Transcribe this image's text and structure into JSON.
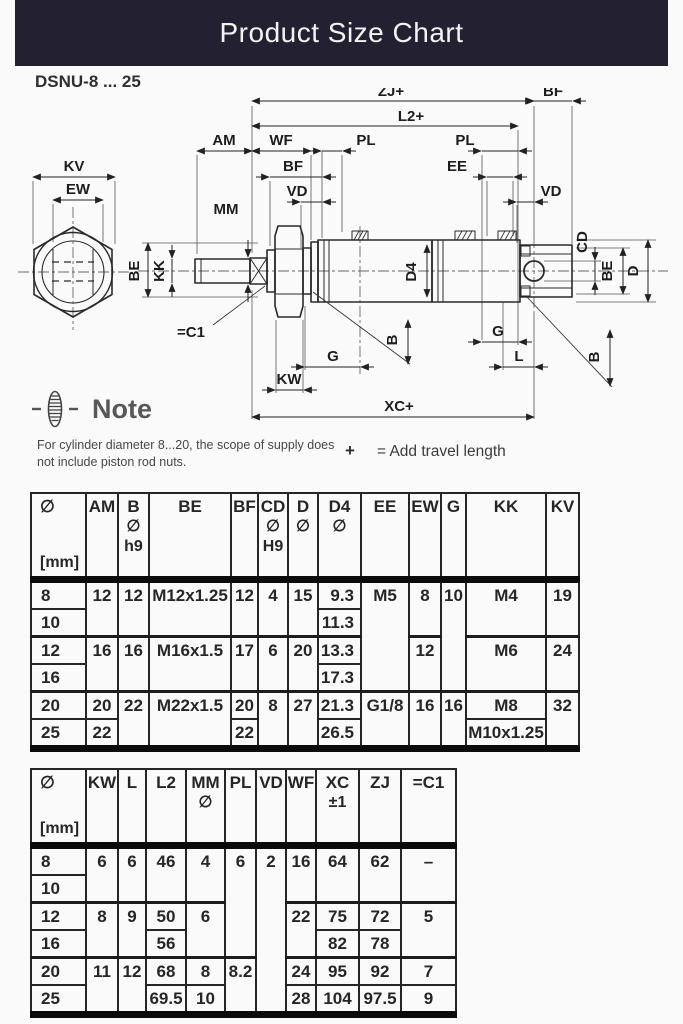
{
  "title": "Product Size Chart",
  "theme": {
    "header_bg": "#232032",
    "header_text": "#f3f3f3",
    "line": "#262626",
    "thick_line": "#0b0b0b"
  },
  "diagram": {
    "model": "DSNU-8 ... 25",
    "labels": {
      "zj": "ZJ+",
      "bf_top": "BF",
      "l2": "L2+",
      "am": "AM",
      "wf": "WF",
      "pl_left": "PL",
      "pl_right": "PL",
      "ee": "EE",
      "kv": "KV",
      "ew": "EW",
      "bf_left": "BF",
      "vd_left": "VD",
      "vd_right": "VD",
      "mm": "MM",
      "be_left": "BE",
      "kk": "KK",
      "d4": "D4",
      "cd": "CD",
      "be_right": "BE",
      "d": "D",
      "b_left": "B",
      "b_right": "B",
      "g_left": "G",
      "g_right": "G",
      "l": "L",
      "kw": "KW",
      "xc": "XC+",
      "torque": "=C1"
    }
  },
  "note": {
    "heading": "Note",
    "body": "For cylinder diameter 8...20, the scope of supply does not include piston rod nuts.",
    "plus": "+",
    "travel": "= Add travel length"
  },
  "table1": {
    "headers": {
      "dia": {
        "l1": "∅",
        "l3": "[mm]"
      },
      "am": "AM",
      "b": {
        "l1": "B",
        "l2": "∅",
        "l3": "h9"
      },
      "be": "BE",
      "bf": "BF",
      "cd": {
        "l1": "CD",
        "l2": "∅",
        "l3": "H9"
      },
      "d": {
        "l1": "D",
        "l2": "∅"
      },
      "d4": {
        "l1": "D4",
        "l2": "∅"
      },
      "ee": "EE",
      "ew": "EW",
      "g": "G",
      "kk": "KK",
      "kv": "KV"
    },
    "rows": {
      "8": {
        "dia": "8",
        "am": "12",
        "b": "12",
        "be": "M12x1.25",
        "bf": "12",
        "cd": "4",
        "d": "15",
        "d4": "9.3",
        "ee": "M5",
        "ew": "8",
        "g": "10",
        "kk": "M4",
        "kv": "19"
      },
      "10": {
        "dia": "10",
        "d4": "11.3"
      },
      "12": {
        "dia": "12",
        "am": "16",
        "b": "16",
        "be": "M16x1.5",
        "bf": "17",
        "cd": "6",
        "d": "20",
        "d4": "13.3",
        "ew": "12",
        "kk": "M6",
        "kv": "24"
      },
      "16": {
        "dia": "16",
        "d4": "17.3"
      },
      "20": {
        "dia": "20",
        "am": "20",
        "b": "22",
        "be": "M22x1.5",
        "bf": "20",
        "cd": "8",
        "d": "27",
        "d4": "21.3",
        "ee": "G1/8",
        "ew": "16",
        "g": "16",
        "kk": "M8",
        "kv": "32"
      },
      "25": {
        "dia": "25",
        "am": "22",
        "bf": "22",
        "d4": "26.5",
        "kk": "M10x1.25"
      }
    }
  },
  "table2": {
    "headers": {
      "dia": {
        "l1": "∅",
        "l3": "[mm]"
      },
      "kw": "KW",
      "l": "L",
      "l2": "L2",
      "mm": {
        "l1": "MM",
        "l2": "∅"
      },
      "pl": "PL",
      "vd": "VD",
      "wf": "WF",
      "xc": {
        "l1": "XC",
        "l2": "±1"
      },
      "zj": "ZJ",
      "c1": "=C1"
    },
    "rows": {
      "8": {
        "dia": "8",
        "kw": "6",
        "l": "6",
        "l2": "46",
        "mm": "4",
        "pl": "6",
        "vd": "2",
        "wf": "16",
        "xc": "64",
        "zj": "62",
        "c1": "–"
      },
      "10": {
        "dia": "10"
      },
      "12": {
        "dia": "12",
        "kw": "8",
        "l": "9",
        "l2": "50",
        "mm": "6",
        "wf": "22",
        "xc": "75",
        "zj": "72",
        "c1": "5"
      },
      "16": {
        "dia": "16",
        "l2": "56",
        "xc": "82",
        "zj": "78"
      },
      "20": {
        "dia": "20",
        "kw": "11",
        "l": "12",
        "l2": "68",
        "mm": "8",
        "pl": "8.2",
        "wf": "24",
        "xc": "95",
        "zj": "92",
        "c1": "7"
      },
      "25": {
        "dia": "25",
        "l2": "69.5",
        "mm": "10",
        "wf": "28",
        "xc": "104",
        "zj": "97.5",
        "c1": "9"
      }
    }
  }
}
